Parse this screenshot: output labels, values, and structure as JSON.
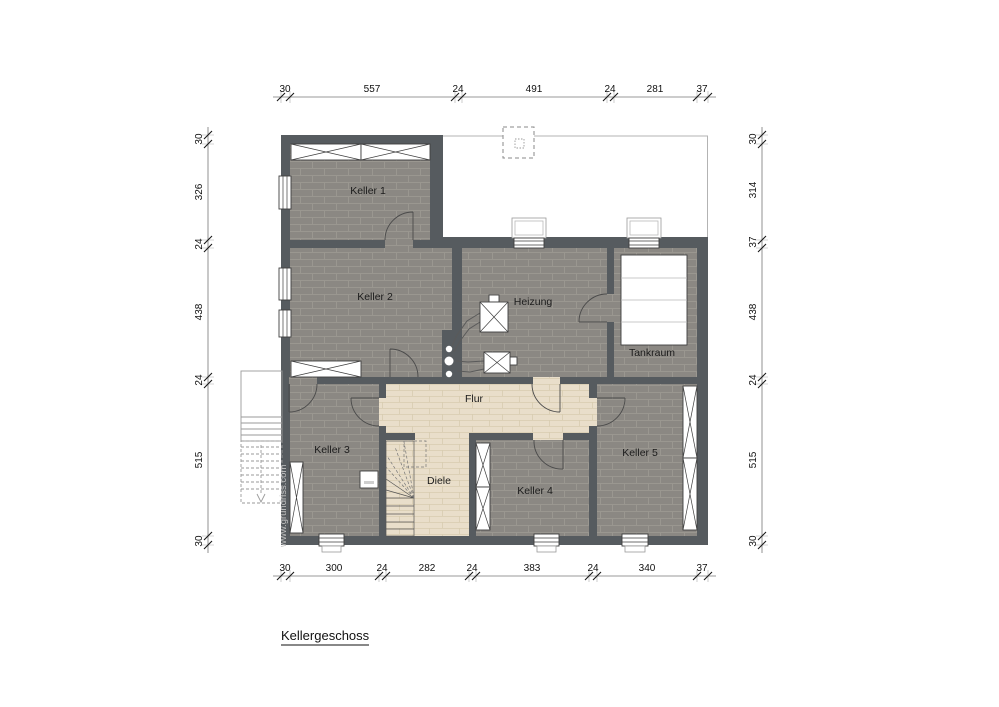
{
  "title": "Kellergeschoss",
  "watermark": "www.grundriss.com",
  "rooms": {
    "keller1": "Keller 1",
    "keller2": "Keller 2",
    "keller3": "Keller 3",
    "keller4": "Keller 4",
    "keller5": "Keller 5",
    "heizung": "Heizung",
    "tankraum": "Tankraum",
    "flur": "Flur",
    "diele": "Diele"
  },
  "dimensions": {
    "top": [
      "30",
      "557",
      "24",
      "491",
      "24",
      "281",
      "37"
    ],
    "bottom": [
      "30",
      "300",
      "24",
      "282",
      "24",
      "383",
      "24",
      "340",
      "37"
    ],
    "left": [
      "30",
      "326",
      "24",
      "438",
      "24",
      "515",
      "30"
    ],
    "right": [
      "30",
      "314",
      "37",
      "438",
      "24",
      "515",
      "30"
    ]
  },
  "colors": {
    "wall": "#565b5f",
    "brick_floor": "#8b8883",
    "brick_joint": "#9a9790",
    "wood_floor": "#e9deca",
    "wood_joint": "#d8ccb0",
    "outline": "#b3b3b3",
    "dimension_text": "#111111"
  }
}
